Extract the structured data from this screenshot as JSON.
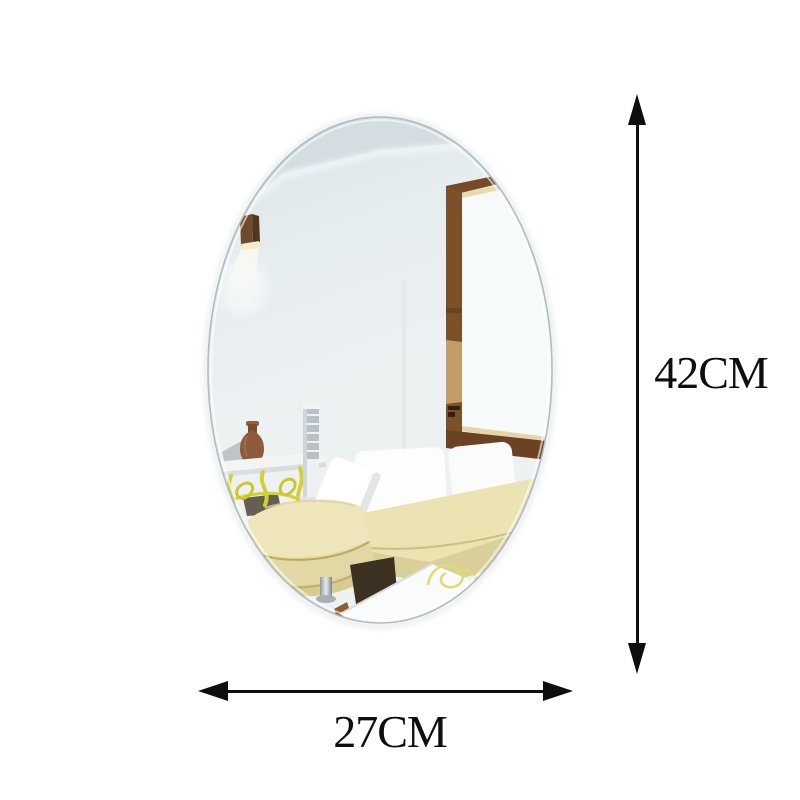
{
  "dimensions": {
    "height": {
      "label": "42CM"
    },
    "width": {
      "label": "27CM"
    }
  },
  "colors": {
    "background": "#ffffff",
    "annotation": "#0e0e0e",
    "mirror_tint": "#e7edf0",
    "mirror_ceiling": "#d4dde1",
    "mirror_edge": "#aeb8bc",
    "wood_frame_dark": "#7c5129",
    "wood_frame_light": "#c49c66",
    "lamp_wood": "#6f4b2d",
    "sofa_fabric": "#ebe3b2",
    "sofa_fabric_shade": "#d9cf9b",
    "iron_table_yellow": "#d2d133",
    "vase_brown": "#8d5b3b",
    "floor_shadow": "#3d3122"
  },
  "scene": {
    "objects": [
      "oval-mirror-sticker",
      "reflected-wall-lamp",
      "reflected-window-frame",
      "reflected-console-table",
      "reflected-vase",
      "reflected-pedestal-column",
      "reflected-sectional-sofa",
      "reflected-side-table"
    ]
  }
}
